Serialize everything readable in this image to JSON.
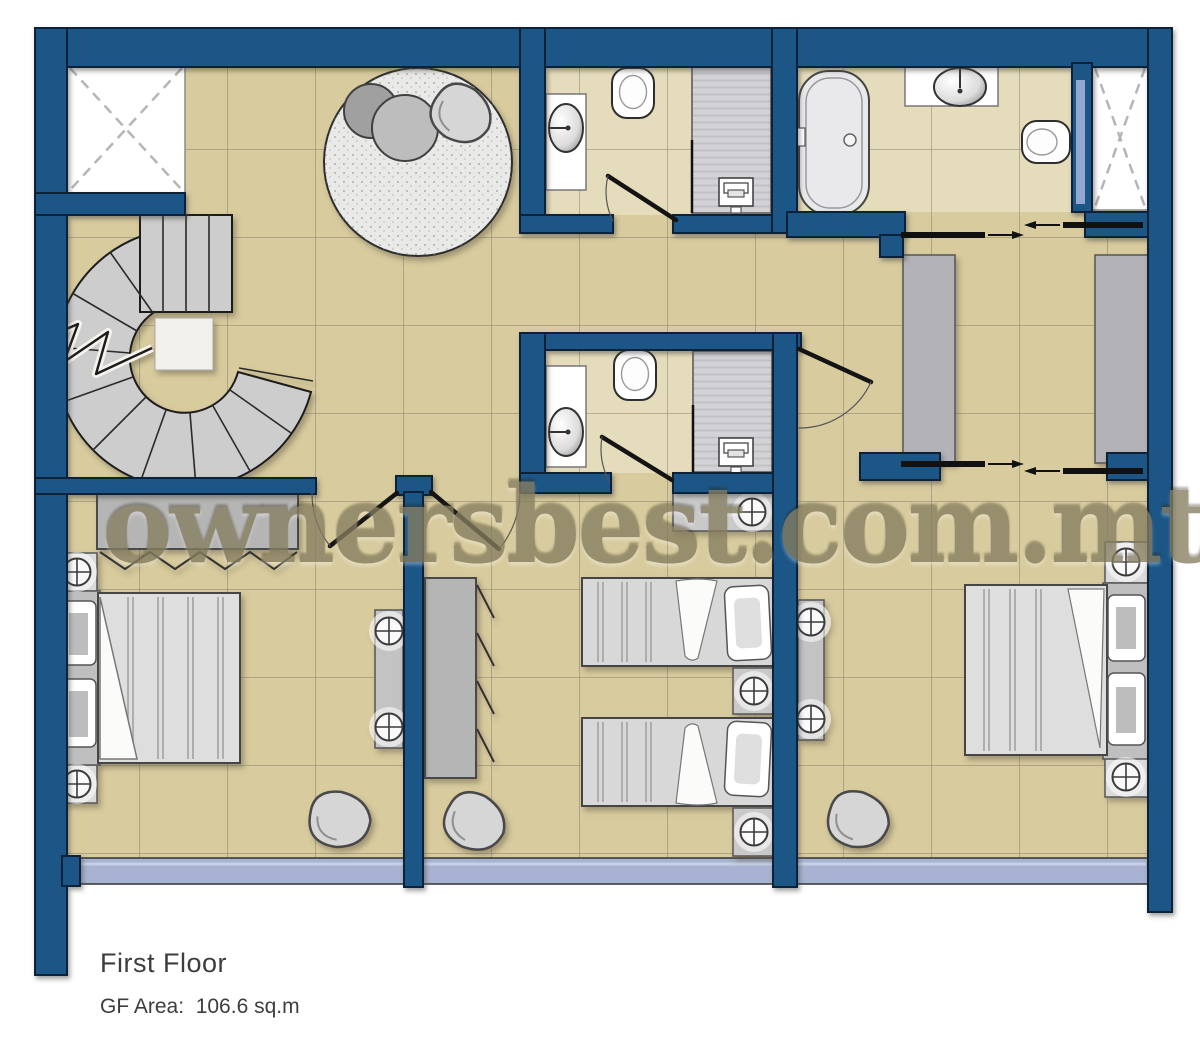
{
  "window": {
    "width": 1200,
    "height": 1049,
    "background": "#ffffff"
  },
  "plan": {
    "title": "First Floor",
    "area_label": "GF Area:  106.6 sq.m",
    "watermark": "ownersbest.com.mt"
  },
  "colors": {
    "wall": "#1d5787",
    "wall-outline": "#0b2238",
    "floor": "#d8cb9e",
    "bath-floor": "#e5dcbb",
    "tile-line": "#80796a",
    "balcony": "#a8b3d2",
    "watermark": "#867e60",
    "furniture-gray": "#c9c9c9",
    "text": "#3d3d3d"
  }
}
